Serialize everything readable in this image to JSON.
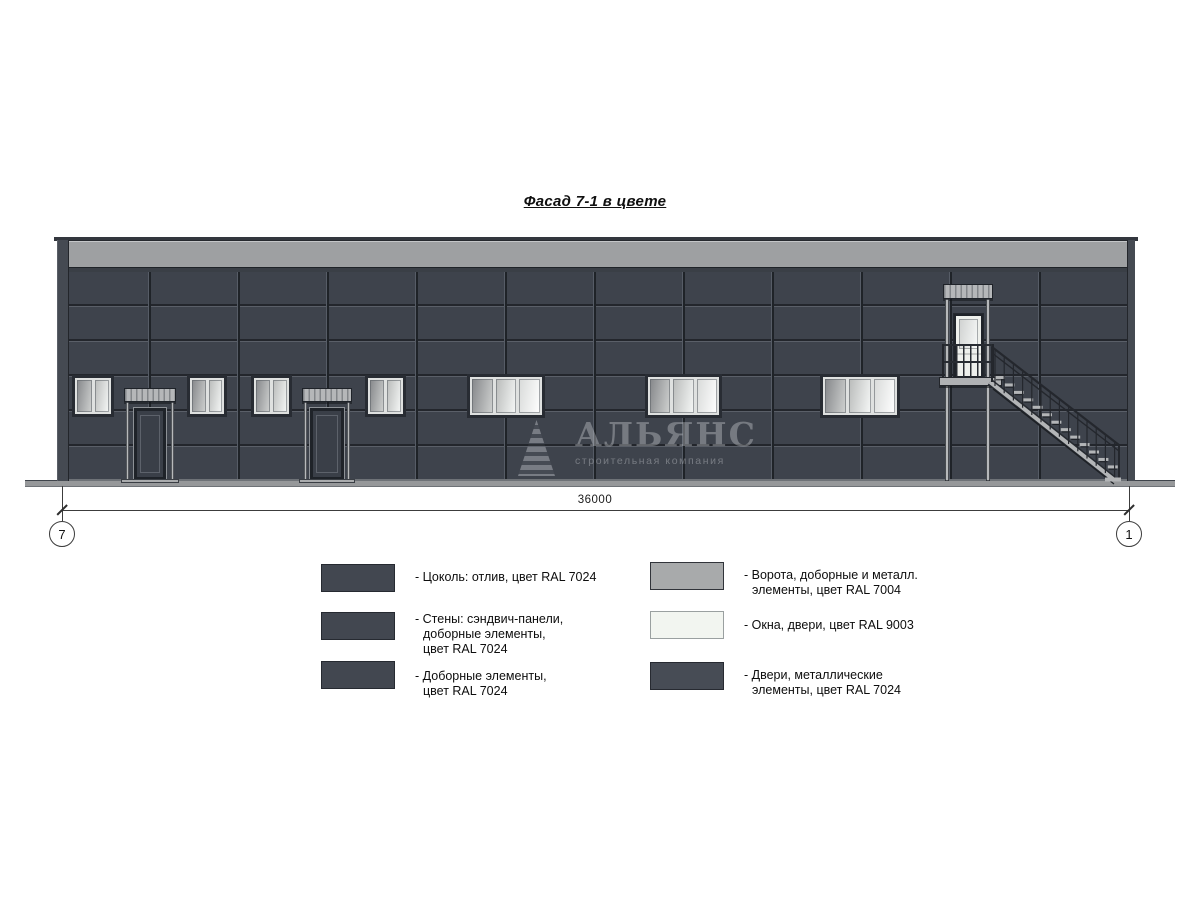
{
  "title": "Фасад 7-1 в цвете",
  "dimension": {
    "value": "36000",
    "axis_left": "7",
    "axis_right": "1"
  },
  "watermark": {
    "name": "АЛЬЯНС",
    "subtitle": "строительная компания"
  },
  "legend": {
    "left": [
      {
        "color": "#424750",
        "lines": [
          "- Цоколь: отлив, цвет RAL 7024"
        ]
      },
      {
        "color": "#424750",
        "lines": [
          "- Стены: сэндвич-панели,",
          "доборные элементы,",
          "цвет RAL 7024"
        ]
      },
      {
        "color": "#424750",
        "lines": [
          "- Доборные элементы,",
          "цвет RAL 7024"
        ]
      }
    ],
    "right": [
      {
        "color": "#a8aaab",
        "lines": [
          "- Ворота, доборные и металл.",
          "элементы, цвет RAL 7004"
        ]
      },
      {
        "color": "#f2f5f0",
        "lines": [
          "- Окна, двери, цвет RAL 9003"
        ]
      },
      {
        "color": "#474c55",
        "lines": [
          "- Двери, металлические",
          "элементы, цвет RAL 7024"
        ]
      }
    ]
  },
  "palette": {
    "walls_ral7024": "#3e434c",
    "gates_ral7004": "#9ea0a2",
    "windows_ral9003": "#f2f5f0"
  }
}
